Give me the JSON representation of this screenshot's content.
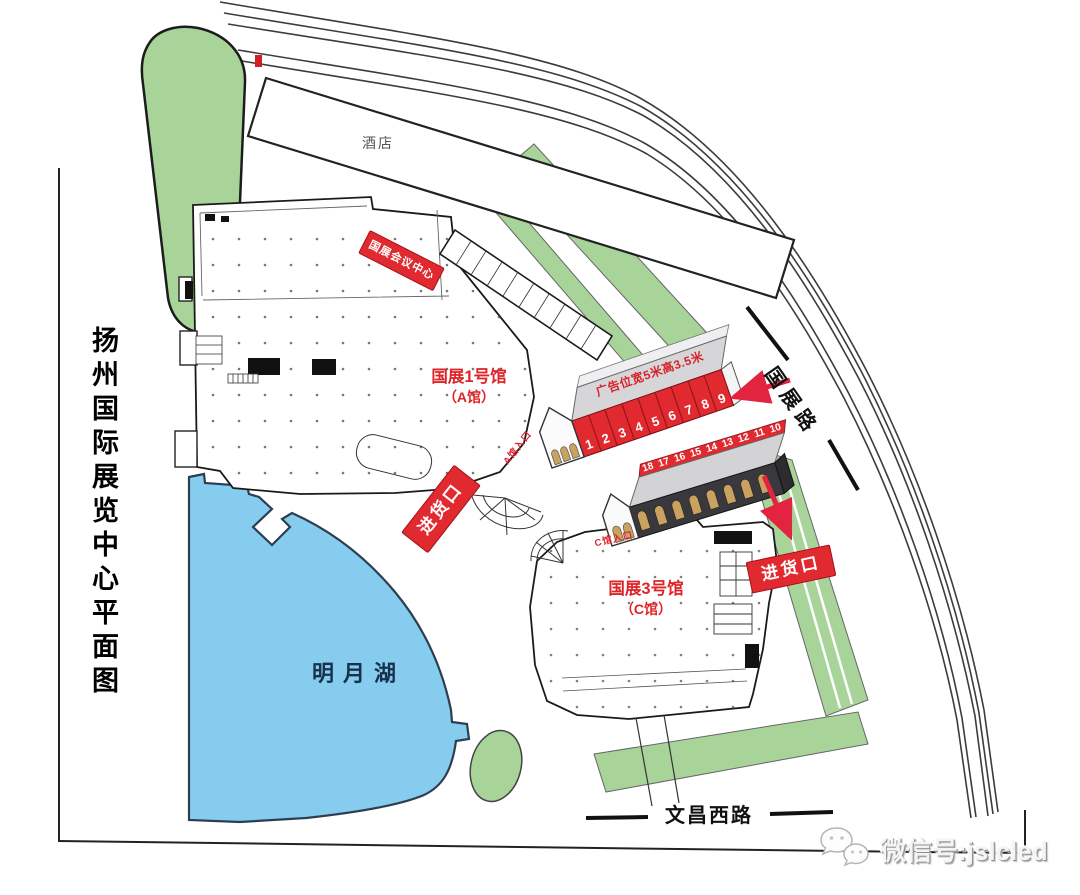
{
  "map": {
    "title": "扬州国际展览中心平面图",
    "hotel_label": "酒店",
    "conference_label": "国展会议中心",
    "lake_label": "明月湖",
    "roads": {
      "guozhan": "国展路",
      "wenchang": "文昌西路"
    },
    "hall_a": {
      "name": "国展1号馆",
      "sub": "（A馆）",
      "entrance": "A馆入口",
      "loading": "进货口"
    },
    "hall_c": {
      "name": "国展3号馆",
      "sub": "（C馆）",
      "entrance": "C馆入口",
      "loading": "进货口"
    },
    "ad_note": "广告位宽5米高3.5米",
    "ad_panels_a": [
      "1",
      "2",
      "3",
      "4",
      "5",
      "6",
      "7",
      "8",
      "9"
    ],
    "ad_panels_c": [
      "18",
      "17",
      "16",
      "15",
      "14",
      "13",
      "12",
      "11",
      "10"
    ],
    "watermark": "微信号:jslcled",
    "colors": {
      "green": "#a8d49a",
      "lake_blue": "#85ccee",
      "banner_red": "#e12a30",
      "arrow_red": "#e22440"
    }
  }
}
